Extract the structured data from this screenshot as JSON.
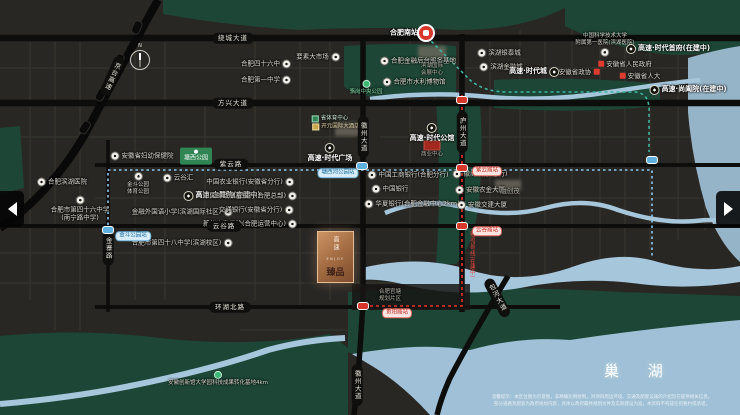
{
  "palette": {
    "bg": "#282724",
    "park": "#1d4636",
    "water": "#a6c6dc",
    "lake": "#9fc0d6",
    "road": "#0d0d0c",
    "accent_red": "#d8372c",
    "metro_teal": "#3fb3a0",
    "metro_blue": "#8ec9ee",
    "copper": "#a76f45"
  },
  "compass_n": "N",
  "lake_label": "巢 湖",
  "logo": {
    "brand_vertical": "高速",
    "latin": "ENJOY",
    "name": "臻品"
  },
  "nav": {
    "left_arrow": "◀",
    "right_arrow": "▶"
  },
  "disclaimer": {
    "line1": "温馨提示：本区位图为示意图，非精确比例绘制，对项目周边环境、交通及配套设施的介绍旨在提供相关信息，",
    "line2": "部分道路及配套为政府规划内容，具体以政府最终规划文件及实际建设为准，本资料不构成任何要约或承诺。"
  },
  "map": {
    "road_labels": [
      {
        "text": "绕城大道",
        "x": 233,
        "y": 38,
        "o": "h"
      },
      {
        "text": "方兴大道",
        "x": 233,
        "y": 103,
        "o": "h"
      },
      {
        "text": "紫云路",
        "x": 231,
        "y": 164,
        "o": "h"
      },
      {
        "text": "云谷路",
        "x": 224,
        "y": 226,
        "o": "h"
      },
      {
        "text": "环湖北路",
        "x": 230,
        "y": 307,
        "o": "h"
      },
      {
        "text": "徽州大道",
        "x": 363,
        "y": 137,
        "o": "v"
      },
      {
        "text": "徽州大道",
        "x": 357,
        "y": 385,
        "o": "v"
      },
      {
        "text": "庐州大道",
        "x": 462,
        "y": 132,
        "o": "v"
      },
      {
        "text": "金寨路",
        "x": 108,
        "y": 248,
        "o": "v"
      },
      {
        "text": "包河大道",
        "x": 497,
        "y": 298,
        "o": "v",
        "rot": -28
      },
      {
        "text": "京台高速",
        "x": 112,
        "y": 76,
        "o": "v",
        "rot": 24
      },
      {
        "text": "轨道5号线(在建中)",
        "x": 471,
        "y": 254,
        "o": "v",
        "cls": "redtext"
      }
    ],
    "stations": [
      {
        "x": 462,
        "y": 100,
        "c": "red"
      },
      {
        "x": 462,
        "y": 168,
        "c": "red"
      },
      {
        "x": 462,
        "y": 226,
        "c": "red"
      },
      {
        "x": 363,
        "y": 306,
        "c": "red"
      },
      {
        "x": 108,
        "y": 230,
        "c": "blue"
      },
      {
        "x": 362,
        "y": 166,
        "c": "blue"
      },
      {
        "x": 652,
        "y": 160,
        "c": "blue"
      }
    ],
    "station_labels": [
      {
        "text": "紫云路站",
        "x": 487,
        "y": 171,
        "c": "red"
      },
      {
        "text": "云谷路站",
        "x": 487,
        "y": 231,
        "c": "red"
      },
      {
        "text": "贵阳路站",
        "x": 397,
        "y": 313,
        "c": "red"
      },
      {
        "text": "金斗公园站",
        "x": 133,
        "y": 236,
        "c": "blue"
      },
      {
        "text": "塘西河公园站",
        "x": 338,
        "y": 173,
        "c": "blue"
      }
    ],
    "landmarks": [
      {
        "t": "合肥南站",
        "x": 404,
        "y": 33,
        "cls": "bold"
      },
      {
        "t": "骆岗中央公园",
        "x": 366,
        "y": 88,
        "icon": "dot",
        "side": "t",
        "cls": "green tiny"
      },
      {
        "t": "合肥四十六中",
        "x": 266,
        "y": 64,
        "icon": "w",
        "side": "r"
      },
      {
        "t": "合肥第一中学",
        "x": 266,
        "y": 80,
        "icon": "w",
        "side": "r"
      },
      {
        "t": "要素大市场",
        "x": 318,
        "y": 57,
        "icon": "w",
        "side": "r"
      },
      {
        "t": "合肥金融后台服务基地",
        "x": 418,
        "y": 61,
        "icon": "w",
        "side": "l"
      },
      {
        "t": "合肥市水利博物馆",
        "x": 414,
        "y": 82,
        "icon": "w",
        "side": "l"
      },
      {
        "lines": [
          "滨湖国际",
          "会展中心"
        ],
        "x": 432,
        "y": 70,
        "cls": "tiny gray col"
      },
      {
        "t": "滨湖银泰城",
        "x": 499,
        "y": 53,
        "icon": "w",
        "side": "l"
      },
      {
        "t": "滨湖金融城",
        "x": 501,
        "y": 67,
        "icon": "w",
        "side": "l"
      },
      {
        "t": "高速·时代城",
        "x": 534,
        "y": 72,
        "icon": "b",
        "side": "r",
        "cls": "bold"
      },
      {
        "lines": [
          "中国科学技术大学",
          "附属第一医院(滨湖医院)"
        ],
        "x": 605,
        "y": 45,
        "icon": "w",
        "side": "r",
        "cls": "col tiny"
      },
      {
        "t": "高速·时代首府(在建中)",
        "x": 668,
        "y": 49,
        "icon": "b",
        "side": "l",
        "cls": "bold"
      },
      {
        "t": "安徽省人民政府",
        "x": 625,
        "y": 64,
        "icon": "red",
        "side": "l"
      },
      {
        "t": "安徽省政协",
        "x": 579,
        "y": 72,
        "icon": "red",
        "side": "r"
      },
      {
        "t": "安徽省人大",
        "x": 640,
        "y": 76,
        "icon": "red",
        "side": "l"
      },
      {
        "t": "高速·尚阖院(在建中)",
        "x": 688,
        "y": 90,
        "icon": "b",
        "side": "l",
        "cls": "bold"
      },
      {
        "t": "安徽省妇幼保健院",
        "x": 142,
        "y": 156,
        "icon": "w",
        "side": "l"
      },
      {
        "t": "塘西公园",
        "x": 196,
        "y": 156,
        "cls": "greenbox"
      },
      {
        "lines": [
          "金斗公园",
          "体育公园"
        ],
        "x": 138,
        "y": 184,
        "icon": "w",
        "side": "l",
        "cls": "col tiny"
      },
      {
        "t": "云谷汇",
        "x": 178,
        "y": 178,
        "icon": "w",
        "side": "l"
      },
      {
        "t": "高速·白鹭院(在建中)",
        "x": 222,
        "y": 196,
        "icon": "b",
        "side": "l",
        "cls": "bold"
      },
      {
        "t": "金融外国语小学(滨湖国际社区)",
        "x": 182,
        "y": 212,
        "icon": "w",
        "side": "r"
      },
      {
        "t": "合肥市第四十八中学(滨湖校区)",
        "x": 182,
        "y": 243,
        "icon": "w",
        "side": "r"
      },
      {
        "t": "合肥滨湖医院",
        "x": 62,
        "y": 182,
        "icon": "w",
        "side": "l"
      },
      {
        "lines": [
          "合肥市第四十六中学",
          "(南宁路中学)"
        ],
        "x": 80,
        "y": 209,
        "icon": "w",
        "side": "t",
        "cls": "col"
      },
      {
        "t": "中国农业银行(安徽省分行)",
        "x": 250,
        "y": 182,
        "icon": "w",
        "side": "r"
      },
      {
        "t": "中国邮政储蓄银行(合肥总部)",
        "x": 250,
        "y": 196,
        "icon": "w",
        "side": "r"
      },
      {
        "t": "交通银行(安徽省分行)",
        "x": 256,
        "y": 210,
        "icon": "w",
        "side": "r"
      },
      {
        "t": "新华人寿保险(合肥运营中心)",
        "x": 250,
        "y": 224,
        "icon": "w",
        "side": "r"
      },
      {
        "t": "中国工商银行(合肥分行)",
        "x": 408,
        "y": 175,
        "icon": "w",
        "side": "l"
      },
      {
        "t": "中国银行",
        "x": 390,
        "y": 189,
        "icon": "w",
        "side": "l"
      },
      {
        "t": "华夏银行(合肥金融中心2km)",
        "x": 412,
        "y": 204,
        "icon": "w",
        "side": "l"
      },
      {
        "t": "徽商银行(总行)",
        "x": 480,
        "y": 174,
        "icon": "w",
        "side": "l"
      },
      {
        "t": "安徽农金大厦",
        "x": 480,
        "y": 190,
        "icon": "w",
        "side": "l"
      },
      {
        "t": "安徽交建大厦",
        "x": 482,
        "y": 205,
        "icon": "w",
        "side": "l"
      },
      {
        "t": "融创茂",
        "x": 510,
        "y": 191,
        "cls": "gray"
      },
      {
        "t": "省体育中心",
        "x": 330,
        "y": 119,
        "cls": "chip-green"
      },
      {
        "t": "开元国际大酒店",
        "x": 336,
        "y": 127,
        "cls": "chip-gold"
      },
      {
        "t": "高速·时代广场",
        "x": 330,
        "y": 153,
        "icon": "b",
        "side": "t",
        "cls": "bold col"
      },
      {
        "t": "高速·时代公馆",
        "x": 432,
        "y": 133,
        "icon": "b",
        "side": "t",
        "cls": "bold col"
      },
      {
        "t": "商业中心",
        "x": 432,
        "y": 155,
        "cls": "tiny gray"
      },
      {
        "lines": [
          "合肥官塘",
          "规划片区"
        ],
        "x": 390,
        "y": 296,
        "cls": "tiny gray col"
      },
      {
        "t": "安徽创新馆大学园科技成果转化基地4km",
        "x": 218,
        "y": 379,
        "icon": "dot",
        "side": "t",
        "cls": "tiny col"
      }
    ]
  }
}
